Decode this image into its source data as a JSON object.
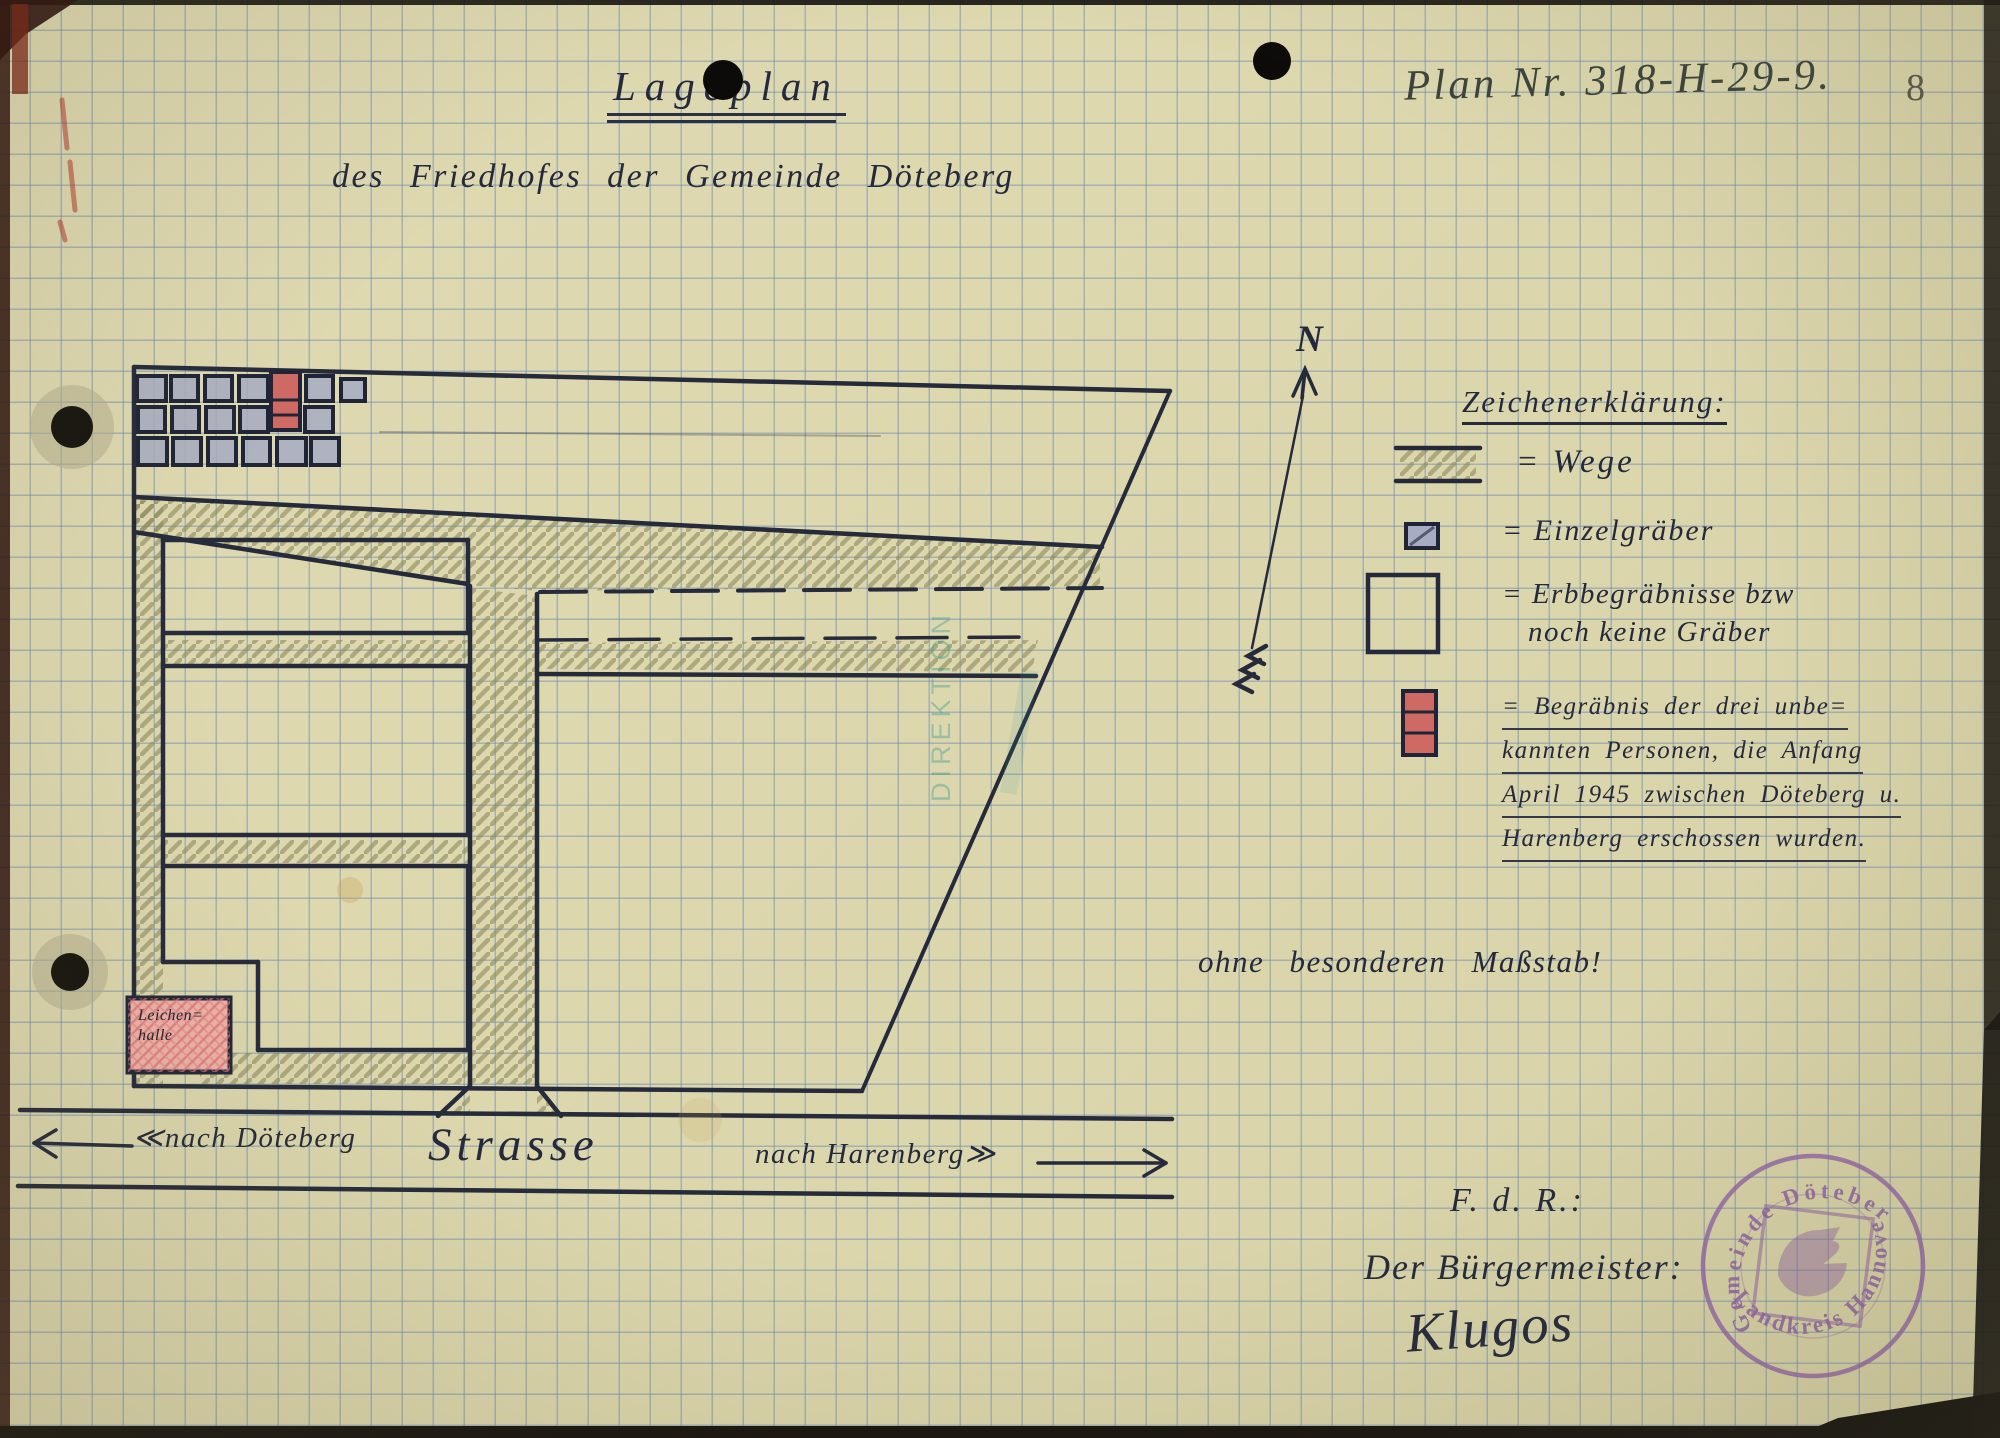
{
  "document": {
    "title": "Lageplan",
    "subtitle": "des Friedhofes der Gemeinde Döteberg",
    "plan_number": "Plan Nr. 318-H-29-9.",
    "page_number": "8"
  },
  "legend": {
    "heading": "Zeichenerklärung:",
    "items": [
      {
        "symbol": "hatched-band",
        "label": "= Wege"
      },
      {
        "symbol": "small-filled-square",
        "label": "= Einzelgräber"
      },
      {
        "symbol": "empty-square",
        "label_line1": "= Erbbegräbnisse bzw",
        "label_line2": "noch keine Gräber"
      },
      {
        "symbol": "red-rectangle",
        "label_lines": [
          "= Begräbnis der drei unbe=",
          "kannten Personen, die Anfang",
          "April 1945 zwischen Döteberg u.",
          "Harenberg erschossen wurden."
        ]
      }
    ]
  },
  "map": {
    "north_label": "N",
    "building_label_line1": "Leichen=",
    "building_label_line2": "halle",
    "watermark": "DIREKTION",
    "scale_note": "ohne besonderen Maßstab!"
  },
  "street": {
    "name": "Strasse",
    "left_direction": "≪nach Döteberg",
    "right_direction": "nach Harenberg≫"
  },
  "signature_block": {
    "certification": "F. d. R.:",
    "signer_title": "Der Bürgermeister:",
    "signature": "Klugos"
  },
  "stamp": {
    "top_text": "Gemeinde Döteberg",
    "bottom_text": "Landkreis Hannover"
  },
  "colors": {
    "paper": "#ddd7ae",
    "grid_blue": "#6c8cb0",
    "ink": "#242a3b",
    "hatch_olive": "#8e8a5c",
    "grave_gray": "#a7acc2",
    "memorial_red": "#ce6a63",
    "leichenhalle_pink": "#f1b1aa",
    "stamp_purple": "#8f62a4",
    "watermark_teal": "#3f9d8f",
    "pencil_gray": "#585850"
  }
}
